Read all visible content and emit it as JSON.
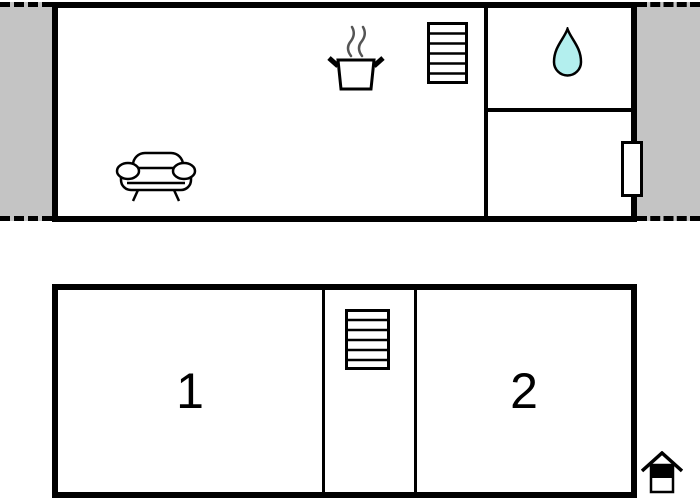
{
  "colors": {
    "wall": "#000000",
    "floor": "#ffffff",
    "adjacent_area": "#c4c4c4",
    "water_drop": "#b3efee"
  },
  "upper_floor": {
    "icons": {
      "sofa": "sofa-icon",
      "stove": "stove-icon",
      "stairs": "stairs-icon",
      "water_drop": "water-drop-icon",
      "window": "window-marker"
    }
  },
  "lower_floor": {
    "rooms": [
      {
        "label": "1"
      },
      {
        "label": "2"
      }
    ],
    "icons": {
      "stairs": "stairs-icon",
      "entrance": "entrance-house-icon"
    }
  }
}
